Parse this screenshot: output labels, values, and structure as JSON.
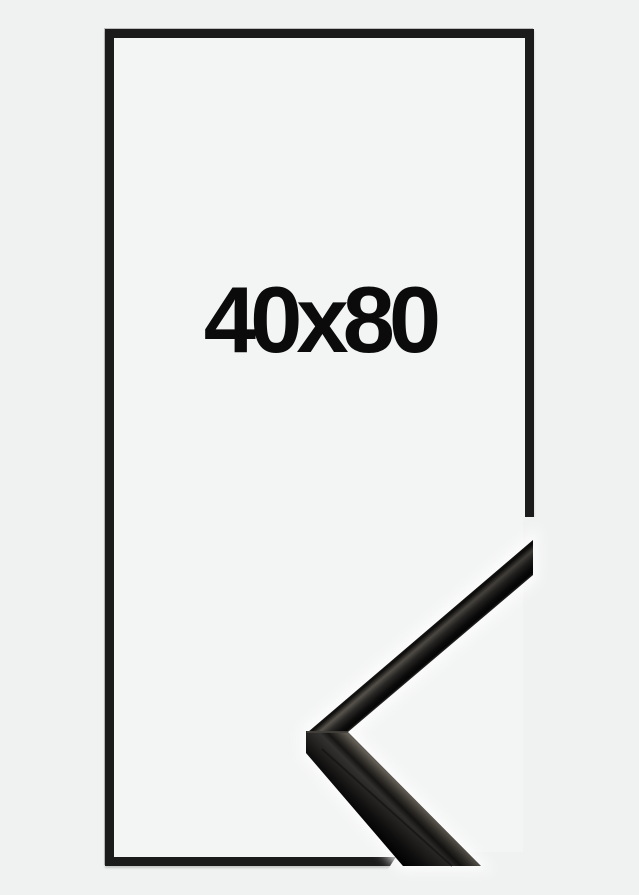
{
  "product": {
    "size_label": "40x80",
    "colors": {
      "background": "#f0f1f1",
      "frame_outline": "#1b1b1b",
      "label_text": "#0b0b0b",
      "moulding_highlight": "#676259",
      "moulding_dark": "#050505"
    }
  }
}
